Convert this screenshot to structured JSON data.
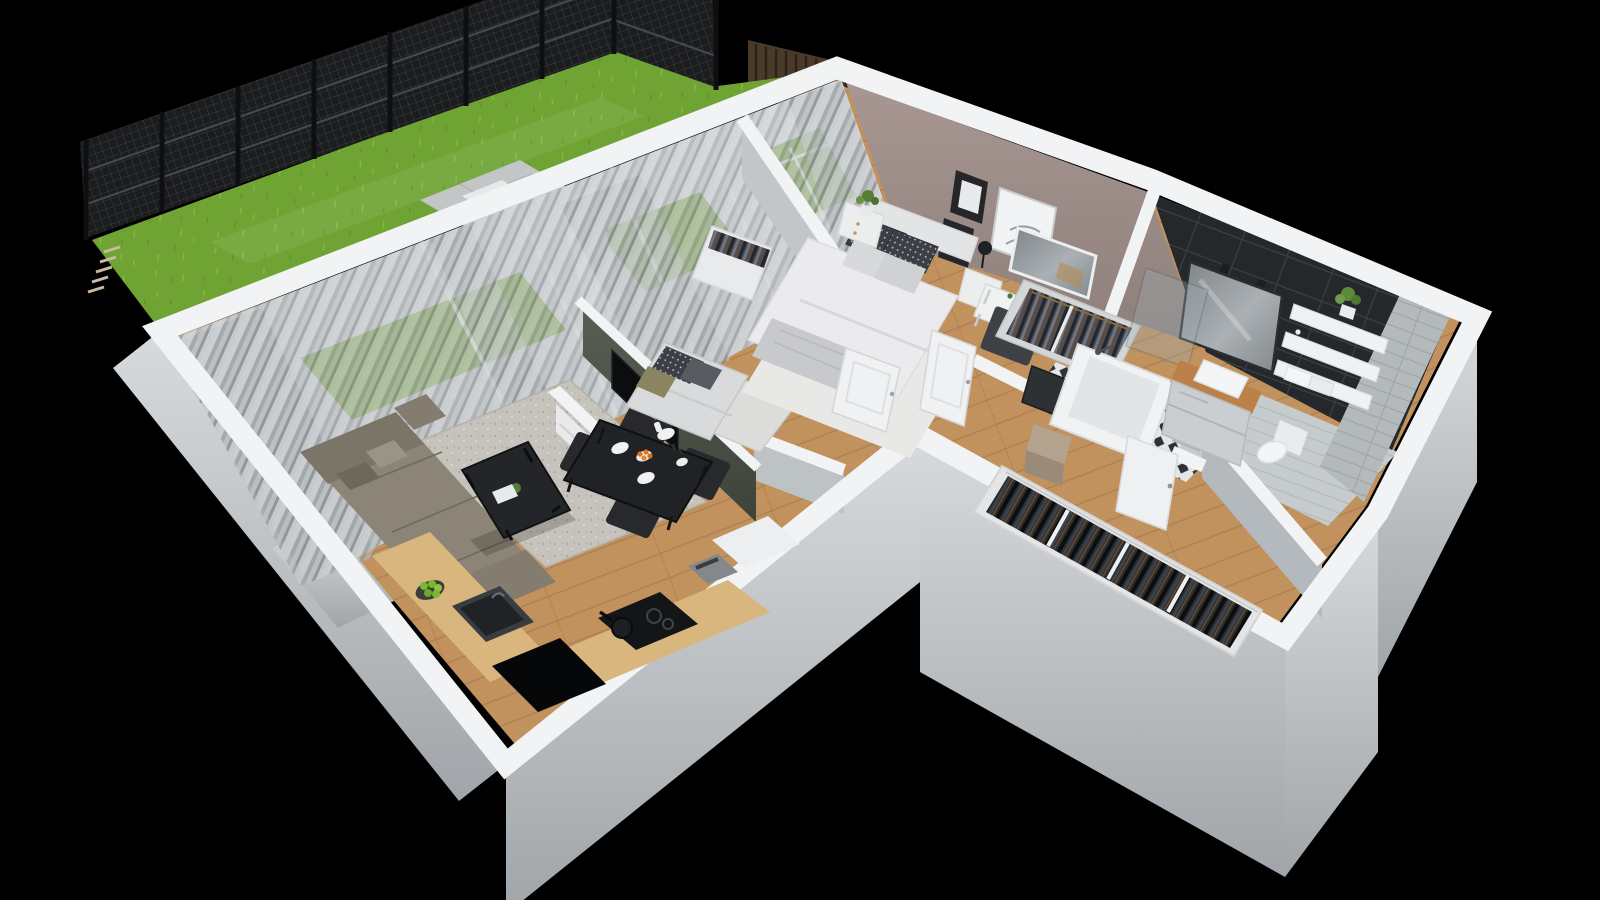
{
  "scene": {
    "kind": "3d-floorplan-render",
    "background": "#000000",
    "description": "isometric cutaway render of an apartment with fenced garden"
  },
  "palette": {
    "background": "#000000",
    "grass": "#6fa333",
    "grassLight": "#85b844",
    "fence": "#1b1c1e",
    "fenceRail": "#45484c",
    "screenBrown": "#4a3a2c",
    "terrace": "#c3c6c7",
    "wallTop": "#f2f3f4",
    "wallFaceLight": "#d8dbdd",
    "wallFaceDark": "#a6abaf",
    "woodFloor": "#c1915e",
    "counterWood": "#d9b67e",
    "vanityWood": "#bb8148",
    "rugLiving": "#c6c3bd",
    "rugOffice": "#dcdcda",
    "rugBedroom": "#e8e8e6",
    "sofa": "#8b8477",
    "sofaDark": "#7b7568",
    "tvWallDark": "#474c45",
    "tvBlack": "#0c0d0e",
    "cabinetWhite": "#e9eaeb",
    "tableBlack": "#202225",
    "chairBlack": "#27292c",
    "mauveWall": "#9c8c88",
    "darkTile": "#24282b",
    "greyTile": "#b4b9bc",
    "duvet": "#ebebed",
    "pillowDark": "#3c4046",
    "blanket": "#c8c9cc",
    "doorWhite": "#f0f1f2",
    "tubWhite": "#f1f2f3",
    "toiletWhite": "#f4f5f6",
    "pouf": "#b3a38e",
    "apple": "#7cb82f",
    "orange": "#e0761f",
    "plantGreen": "#567d35",
    "voidBlack": "#060708"
  },
  "counts": {
    "fence_posts": 8,
    "dining_chairs": 4,
    "bathroom_shelves": 3,
    "wall_pictures": 3,
    "glass_door_frames": 4
  },
  "rooms": [
    {
      "id": "garden",
      "items": [
        "lawn",
        "mesh-fence",
        "terrace-pavers",
        "privacy-screen",
        "step-detail"
      ]
    },
    {
      "id": "living-room",
      "items": [
        "corner-sofa",
        "area-rug",
        "coffee-table",
        "tv-partition-wall",
        "tv",
        "media-cabinet",
        "sheer-curtains",
        "sliding-glass-doors"
      ]
    },
    {
      "id": "dining-area",
      "items": [
        "black-table",
        "four-chairs",
        "plates",
        "flower-vase",
        "fruit-bowl"
      ]
    },
    {
      "id": "kitchen",
      "items": [
        "wood-counter",
        "sink",
        "induction-hob",
        "pan",
        "coffee-machine",
        "floor-void",
        "apple-bowl"
      ]
    },
    {
      "id": "office",
      "items": [
        "daybed",
        "desk",
        "chair",
        "wardrobe",
        "rug"
      ]
    },
    {
      "id": "bedroom",
      "items": [
        "double-bed",
        "headboard",
        "pillows",
        "nightstands",
        "table-lamp",
        "vanity-desk",
        "mirror",
        "chair",
        "open-wardrobe",
        "wall-art",
        "plant",
        "area-rug",
        "doors"
      ]
    },
    {
      "id": "bathroom",
      "items": [
        "bathtub",
        "shower-screen",
        "vanity-basin",
        "mirror",
        "shelves",
        "towels",
        "plant",
        "toilet",
        "dark-tile-wall",
        "grey-tile-wall",
        "patterned-floor",
        "door"
      ]
    },
    {
      "id": "hallway",
      "items": [
        "open-closet",
        "pouf",
        "leaning-mirror",
        "wood-floor"
      ]
    }
  ]
}
